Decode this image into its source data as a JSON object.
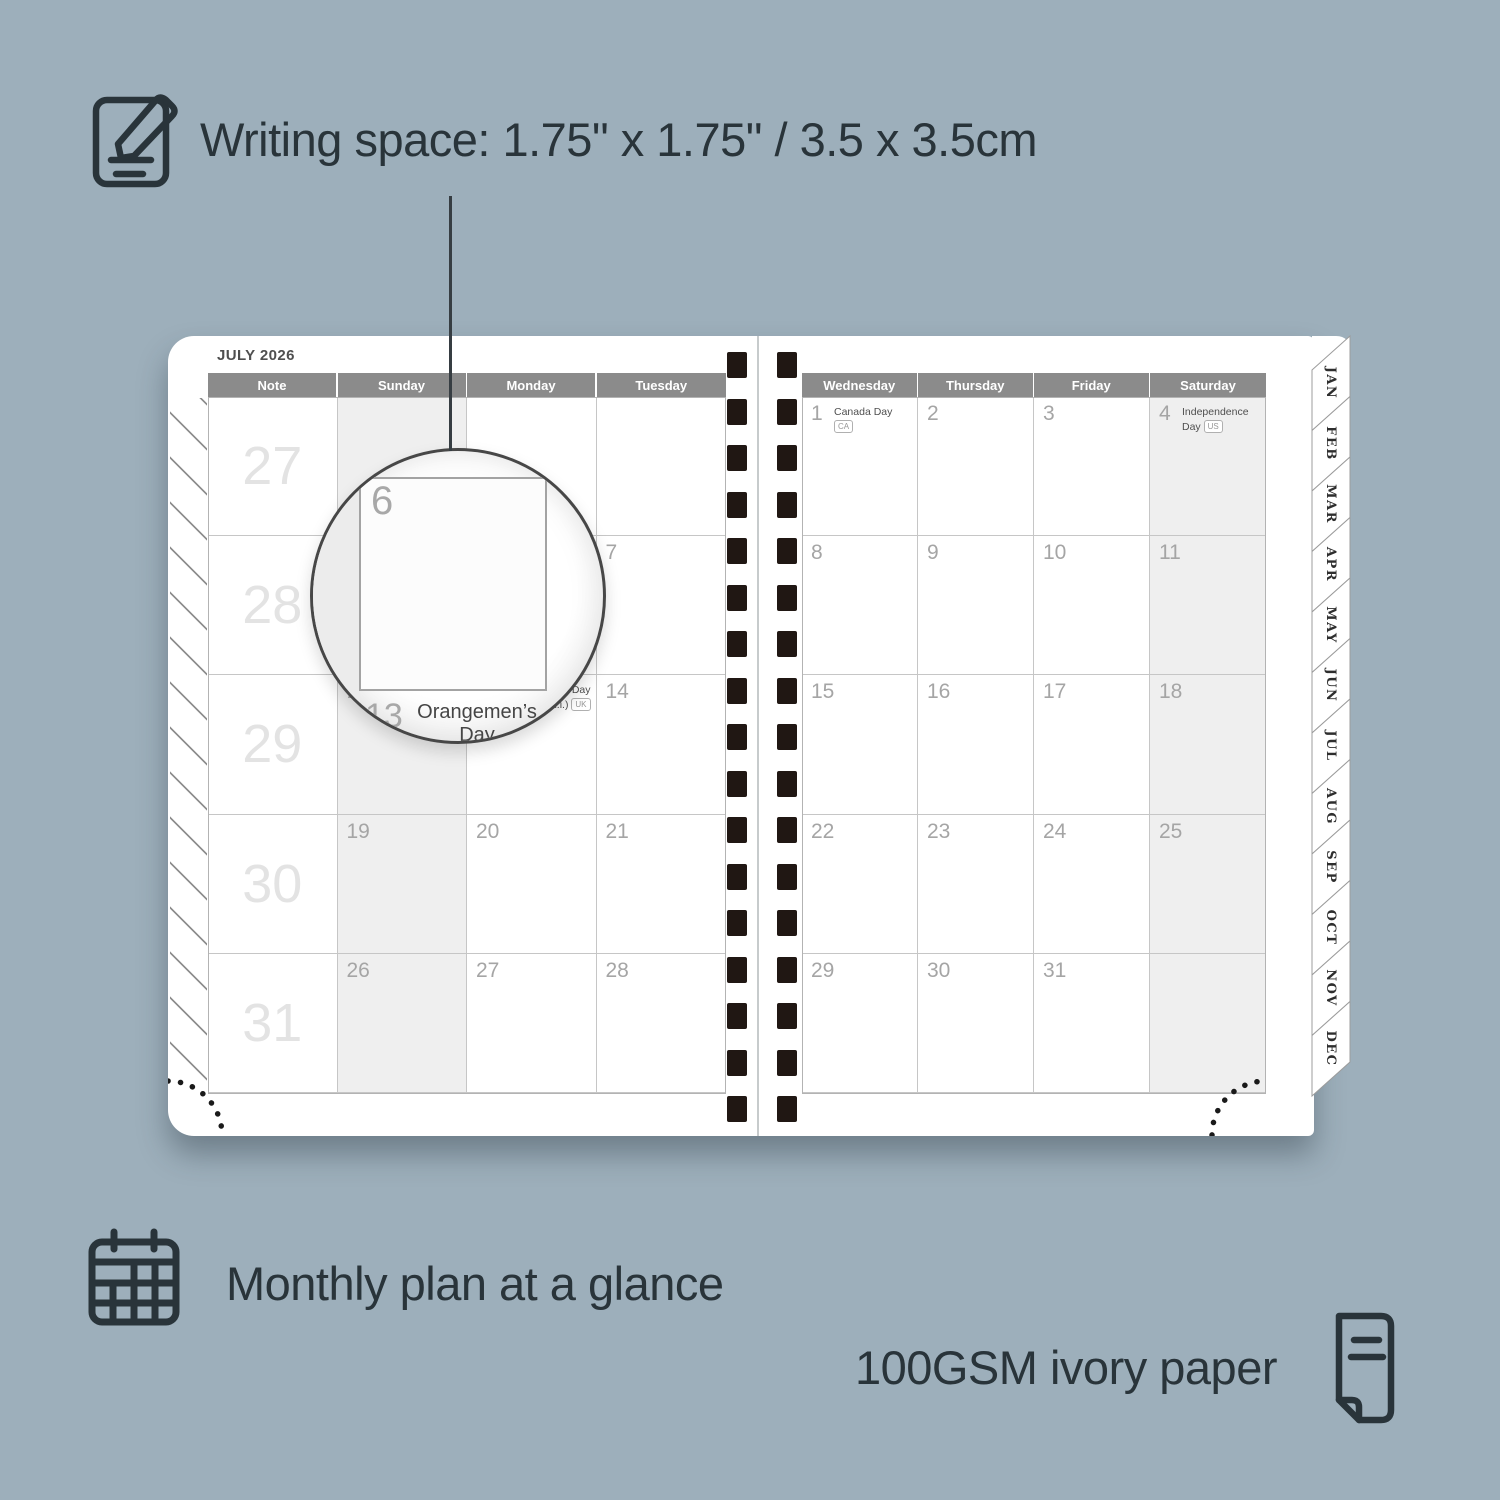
{
  "annotations": {
    "writing_space": "Writing space: 1.75\" x 1.75\" / 3.5 x 3.5cm",
    "monthly_plan": "Monthly plan at a glance",
    "paper": "100GSM ivory paper"
  },
  "planner": {
    "title": "JULY 2026",
    "left_headers": [
      "Note",
      "Sunday",
      "Monday",
      "Tuesday"
    ],
    "right_headers": [
      "Wednesday",
      "Thursday",
      "Friday",
      "Saturday"
    ],
    "week_numbers": [
      "27",
      "28",
      "29",
      "30",
      "31"
    ],
    "left_rows": [
      [
        "",
        "",
        ""
      ],
      [
        "5",
        "6",
        "7"
      ],
      [
        "12",
        "13",
        "14"
      ],
      [
        "19",
        "20",
        "21"
      ],
      [
        "26",
        "27",
        "28"
      ]
    ],
    "right_rows": [
      [
        "1",
        "2",
        "3",
        "4"
      ],
      [
        "8",
        "9",
        "10",
        "11"
      ],
      [
        "15",
        "16",
        "17",
        "18"
      ],
      [
        "22",
        "23",
        "24",
        "25"
      ],
      [
        "29",
        "30",
        "31",
        ""
      ]
    ],
    "holidays": {
      "canada": {
        "name": "Canada Day",
        "badge": "CA"
      },
      "independence": {
        "name": "Independence Day",
        "badge": "US"
      },
      "orangemen": {
        "line1": "Orangemen’s Day",
        "line2": "(n.i.)",
        "badge": "UK"
      }
    },
    "holiday_cells": [
      {
        "page": "left",
        "row": 2,
        "col": 1,
        "ref": "orangemen"
      },
      {
        "page": "right",
        "row": 0,
        "col": 0,
        "ref": "canada"
      },
      {
        "page": "right",
        "row": 0,
        "col": 3,
        "ref": "independence"
      }
    ],
    "month_tabs": [
      "JAN",
      "FEB",
      "MAR",
      "APR",
      "MAY",
      "JUN",
      "JUL",
      "AUG",
      "SEP",
      "OCT",
      "NOV",
      "DEC"
    ],
    "magnifier": {
      "date": "6",
      "below_date": "13"
    }
  },
  "colors": {
    "background": "#9DAFBB",
    "ink": "#29343A",
    "header_bar": "#8B8B8B",
    "date_gray": "#A5A5A5",
    "week_number_gray": "#E3E3E3",
    "weekend_shading": "#EFEFEF",
    "binding_hole": "#201713"
  }
}
